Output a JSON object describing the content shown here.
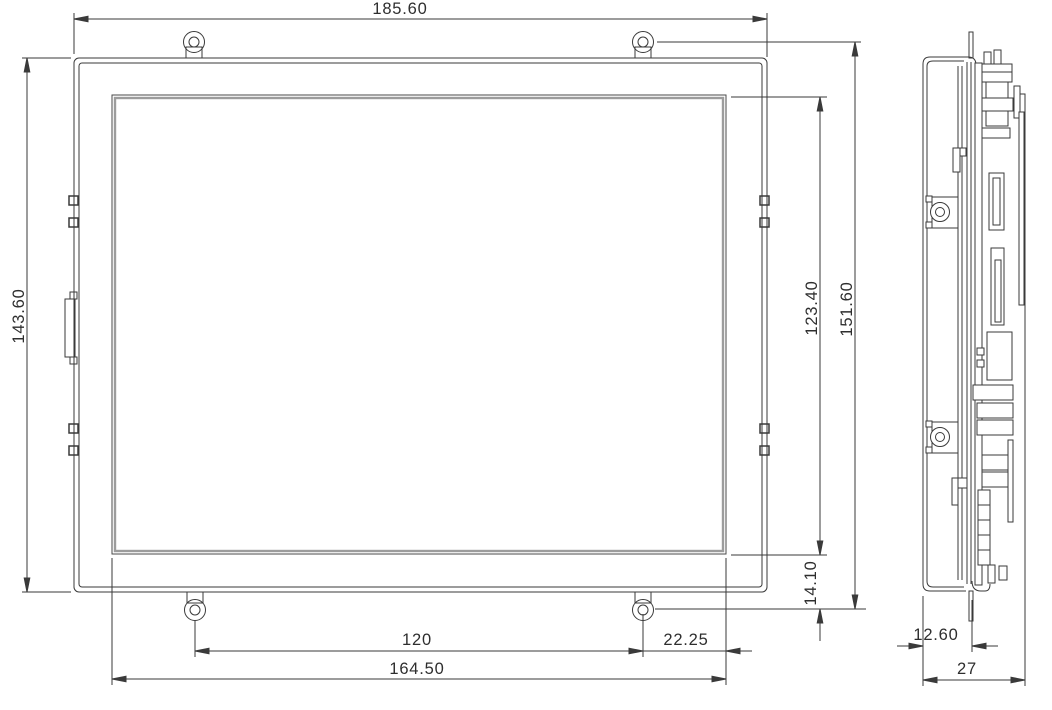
{
  "drawing_type": "engineering-outline-drawing",
  "dim_labels": {
    "overall_width": "185.60",
    "overall_height": "143.60",
    "hole_span_vertical": "151.60",
    "active_area_height": "123.40",
    "active_bottom_to_hole": "14.10",
    "hole_span_horizontal": "120",
    "active_area_width": "164.50",
    "hole_to_active_right": "22.25",
    "bezel_depth": "12.60",
    "overall_depth": "27"
  },
  "colors": {
    "line": "#3a3a3a",
    "display_border_gray": "#9c9c9c",
    "text": "#2e2e2e",
    "background": "#ffffff"
  }
}
